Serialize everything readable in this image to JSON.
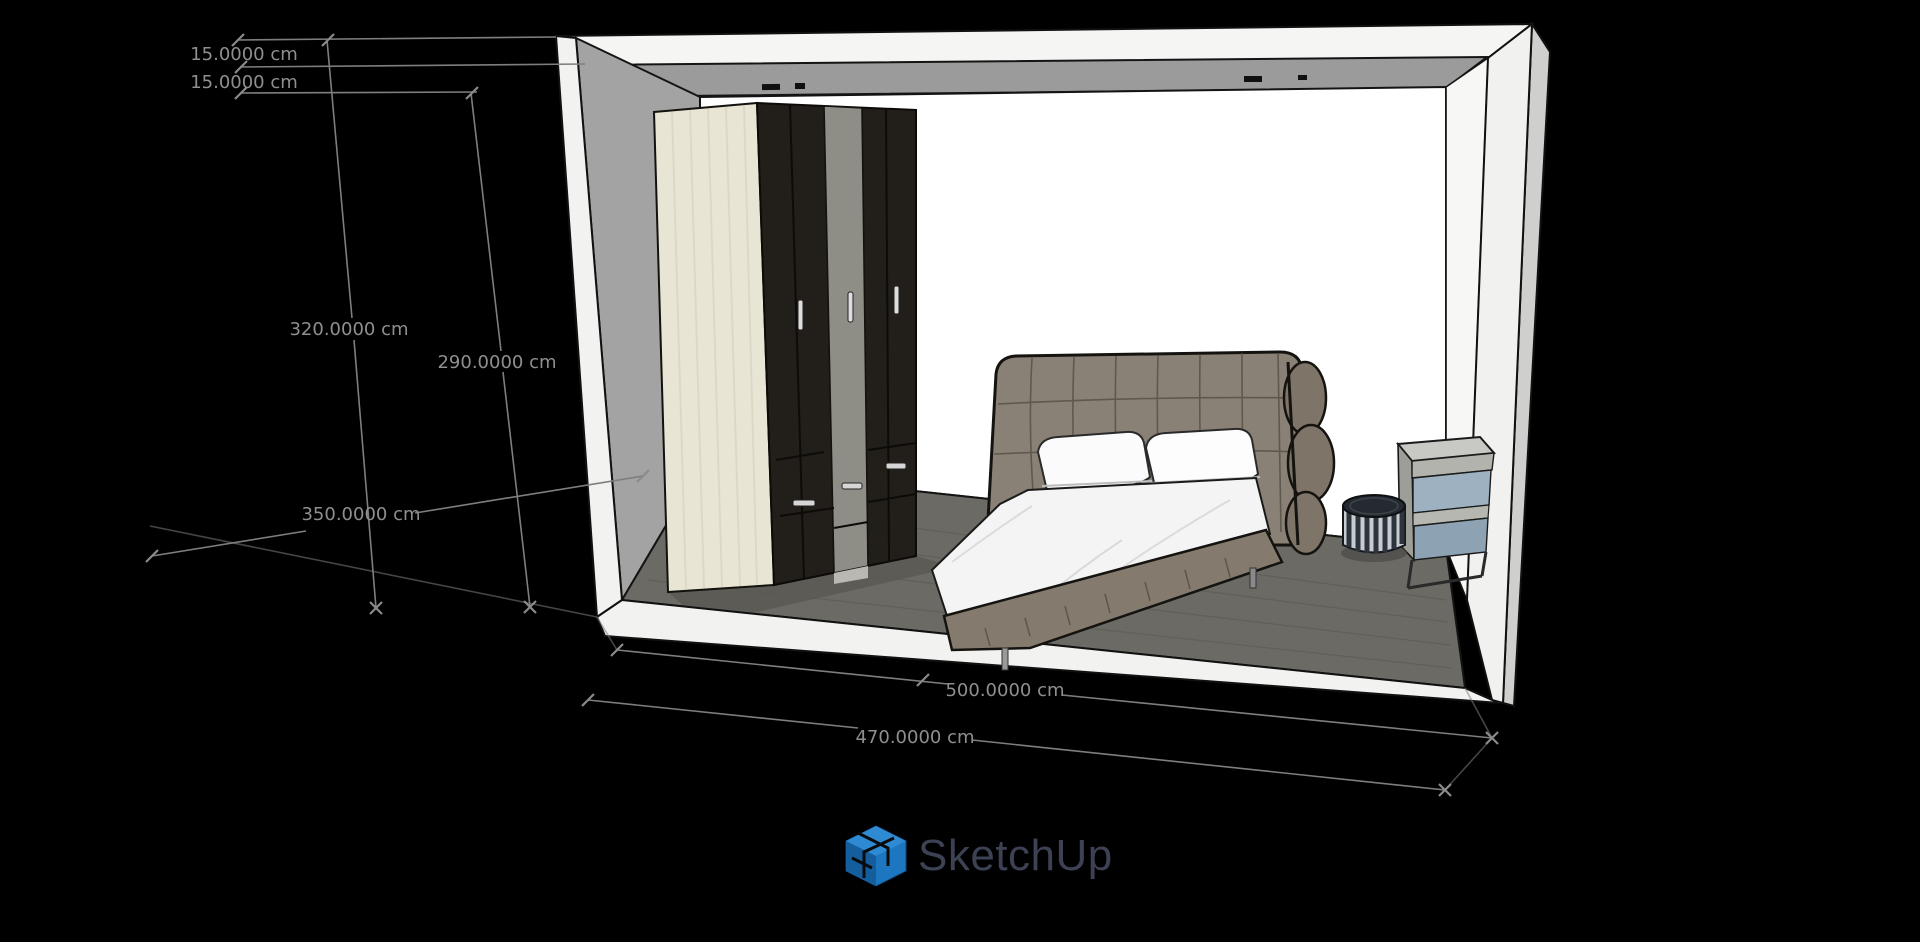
{
  "app": {
    "watermark": "SketchUp"
  },
  "view": {
    "unit": "cm"
  },
  "dimensions": [
    {
      "name": "ceiling-beam-height",
      "label": "15.0000 cm"
    },
    {
      "name": "ceiling-slab-height",
      "label": "15.0000 cm"
    },
    {
      "name": "overall-wall-height",
      "label": "320.0000 cm"
    },
    {
      "name": "interior-wall-height",
      "label": "290.0000 cm"
    },
    {
      "name": "room-depth",
      "label": "350.0000 cm"
    },
    {
      "name": "room-width-outer",
      "label": "500.0000 cm"
    },
    {
      "name": "room-width-inner",
      "label": "470.0000 cm"
    }
  ],
  "colors": {
    "background": "#000000",
    "dimension_line": "#7e7e7e",
    "dimension_text": "#8f8f8f",
    "back_wall": "#ffffff",
    "left_wall": "#a3a3a3",
    "soffit": "#9b9b9b",
    "floor": "#6b6a64",
    "white_shell": "#f4f4f2",
    "wardrobe_dark": "#221f1a",
    "wardrobe_cream": "#e9e5d5",
    "wardrobe_gray_door": "#8e8e86",
    "bed_upholstery": "#8a8176",
    "bedding_white": "#fafafa",
    "nightstand_glass": "#9db1c0",
    "stool_dark": "#242a30",
    "logo_blue": "#1c76c0",
    "logo_text": "#3c4154"
  },
  "scene": {
    "objects": [
      "room-shell",
      "wardrobe",
      "double-bed",
      "nightstand",
      "striped-stool"
    ]
  }
}
